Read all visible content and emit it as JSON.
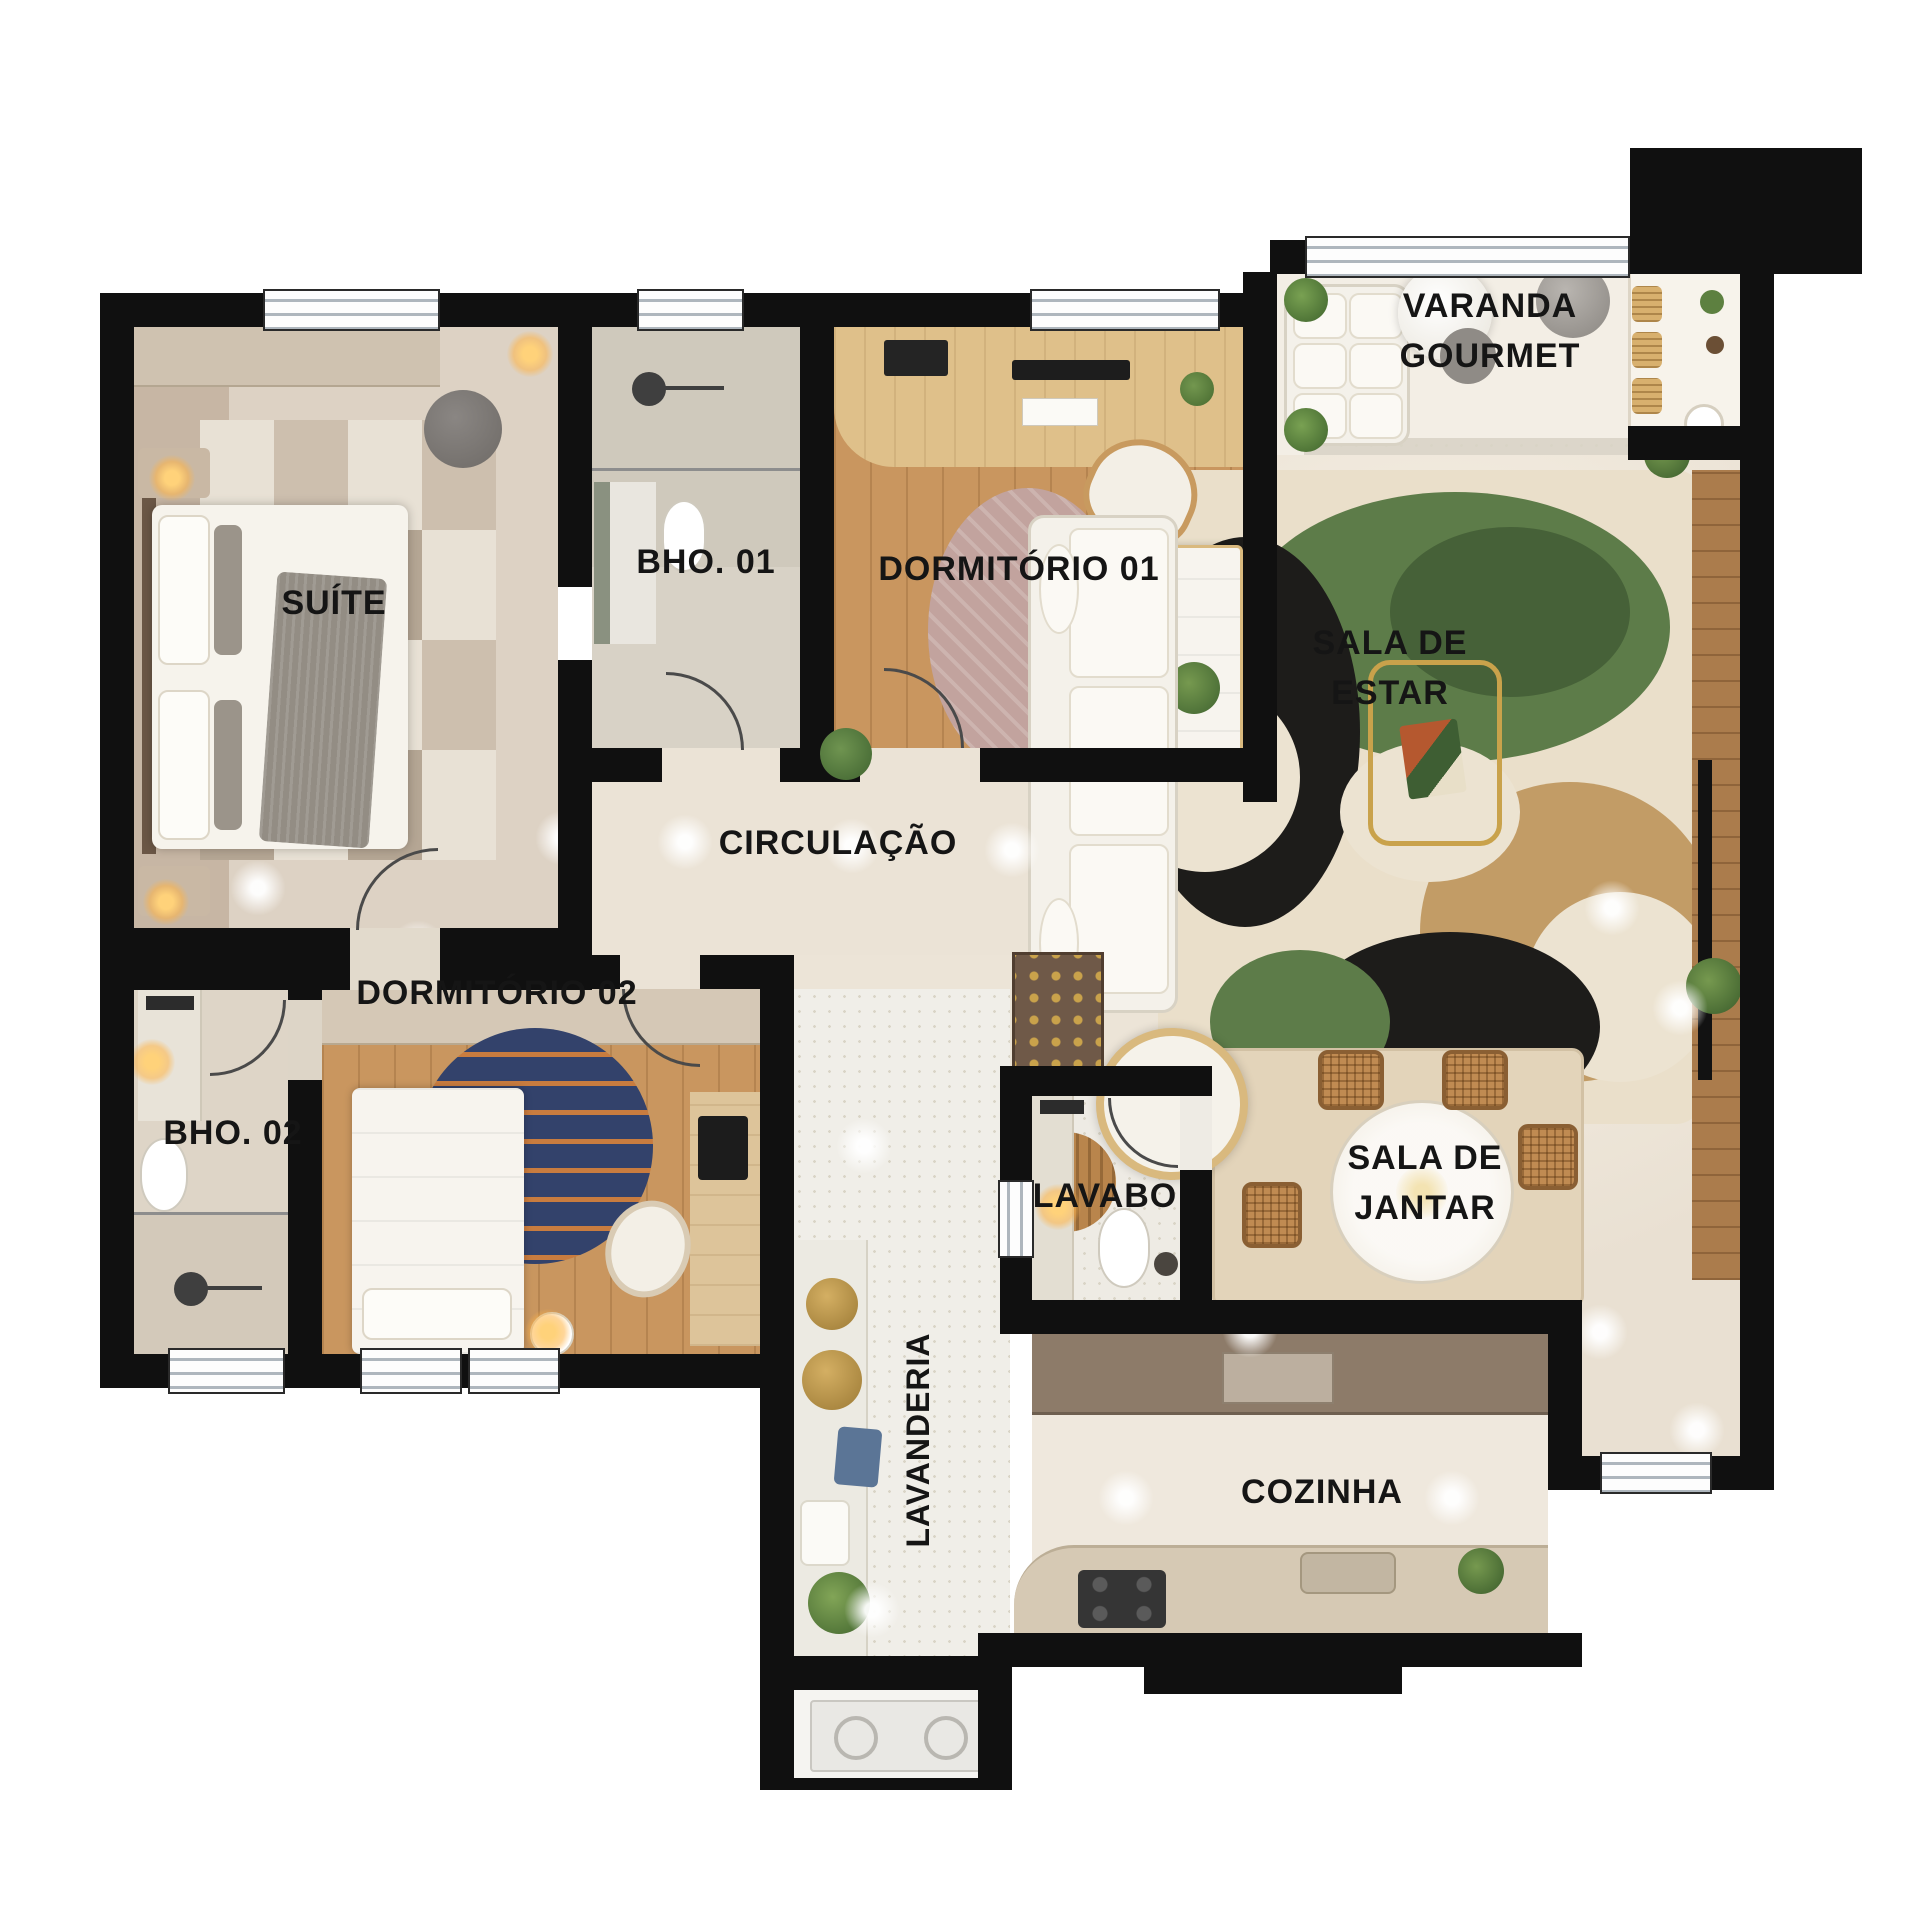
{
  "type": "floor-plan",
  "rooms": [
    {
      "id": "suite",
      "label": "SUÍTE"
    },
    {
      "id": "bho-01",
      "label": "BHO. 01"
    },
    {
      "id": "dormitorio-01",
      "label": "DORMITÓRIO 01"
    },
    {
      "id": "varanda-gourmet",
      "label": "VARANDA\nGOURMET"
    },
    {
      "id": "sala-de-estar",
      "label": "SALA DE\nESTAR"
    },
    {
      "id": "circulacao",
      "label": "CIRCULAÇÃO"
    },
    {
      "id": "dormitorio-02",
      "label": "DORMITÓRIO 02"
    },
    {
      "id": "bho-02",
      "label": "BHO. 02"
    },
    {
      "id": "lavabo",
      "label": "LAVABO"
    },
    {
      "id": "sala-de-jantar",
      "label": "SALA DE\nJANTAR"
    },
    {
      "id": "lavanderia",
      "label": "LAVANDERIA"
    },
    {
      "id": "cozinha",
      "label": "COZINHA"
    }
  ],
  "palette": {
    "wall": "#101010",
    "floor_cream": "#ece4d7",
    "floor_beige": "#d9cec1",
    "floor_wood": "#c9965f",
    "floor_terrazzo": "#f0eee8",
    "rug_green": "#5d7c49",
    "rug_black": "#1d1c1a",
    "rug_tan": "#c29c66",
    "rug_blue": "#33426b",
    "rug_rose": "#c2a39e",
    "rattan": "#c08b52",
    "counter_brown": "#8d7b69",
    "accent_gold": "#c9a24b"
  }
}
